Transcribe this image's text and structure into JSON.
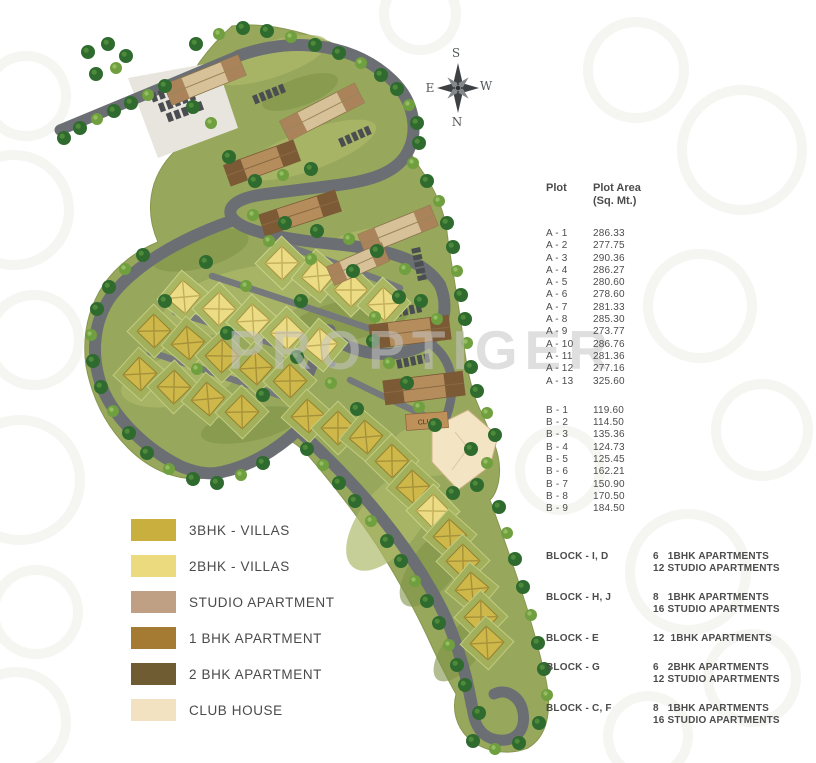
{
  "watermark": "PROPTIGER",
  "compass": {
    "top": "S",
    "left": "E",
    "right": "W",
    "bottom": "N"
  },
  "map": {
    "club_label": "CLUB"
  },
  "plot_table": {
    "col1_header": "Plot",
    "col2_header": "Plot Area\n(Sq. Mt.)",
    "group_a": [
      {
        "plot": "A - 1",
        "area": "286.33"
      },
      {
        "plot": "A - 2",
        "area": "277.75"
      },
      {
        "plot": "A - 3",
        "area": "290.36"
      },
      {
        "plot": "A - 4",
        "area": "286.27"
      },
      {
        "plot": "A - 5",
        "area": "280.60"
      },
      {
        "plot": "A - 6",
        "area": "278.60"
      },
      {
        "plot": "A - 7",
        "area": "281.33"
      },
      {
        "plot": "A - 8",
        "area": "285.30"
      },
      {
        "plot": "A - 9",
        "area": "273.77"
      },
      {
        "plot": "A - 10",
        "area": "286.76"
      },
      {
        "plot": "A - 11",
        "area": "281.36"
      },
      {
        "plot": "A - 12",
        "area": "277.16"
      },
      {
        "plot": "A - 13",
        "area": "325.60"
      }
    ],
    "group_b": [
      {
        "plot": "B - 1",
        "area": "119.60"
      },
      {
        "plot": "B - 2",
        "area": "114.50"
      },
      {
        "plot": "B - 3",
        "area": "135.36"
      },
      {
        "plot": "B - 4",
        "area": "124.73"
      },
      {
        "plot": "B - 5",
        "area": "125.45"
      },
      {
        "plot": "B - 6",
        "area": "162.21"
      },
      {
        "plot": "B - 7",
        "area": "150.90"
      },
      {
        "plot": "B - 8",
        "area": "170.50"
      },
      {
        "plot": "B - 9",
        "area": "184.50"
      }
    ]
  },
  "blocks": [
    {
      "label": "BLOCK - I, D",
      "units": "6   1BHK APARTMENTS\n12 STUDIO APARTMENTS"
    },
    {
      "label": "BLOCK - H, J",
      "units": "8   1BHK APARTMENTS\n16 STUDIO APARTMENTS"
    },
    {
      "label": "BLOCK - E",
      "units": "12  1BHK APARTMENTS"
    },
    {
      "label": "BLOCK - G",
      "units": "6   2BHK APARTMENTS\n12 STUDIO APARTMENTS"
    },
    {
      "label": "BLOCK - C, F",
      "units": "8   1BHK APARTMENTS\n16 STUDIO APARTMENTS"
    }
  ],
  "legend": [
    {
      "label": "3BHK - VILLAS",
      "color": "#c9af3d"
    },
    {
      "label": "2BHK - VILLAS",
      "color": "#ecda7f"
    },
    {
      "label": "STUDIO APARTMENT",
      "color": "#bfa085"
    },
    {
      "label": "1 BHK APARTMENT",
      "color": "#a57a33"
    },
    {
      "label": "2 BHK APARTMENT",
      "color": "#6f5c33"
    },
    {
      "label": "CLUB HOUSE",
      "color": "#f3e2c1"
    }
  ]
}
